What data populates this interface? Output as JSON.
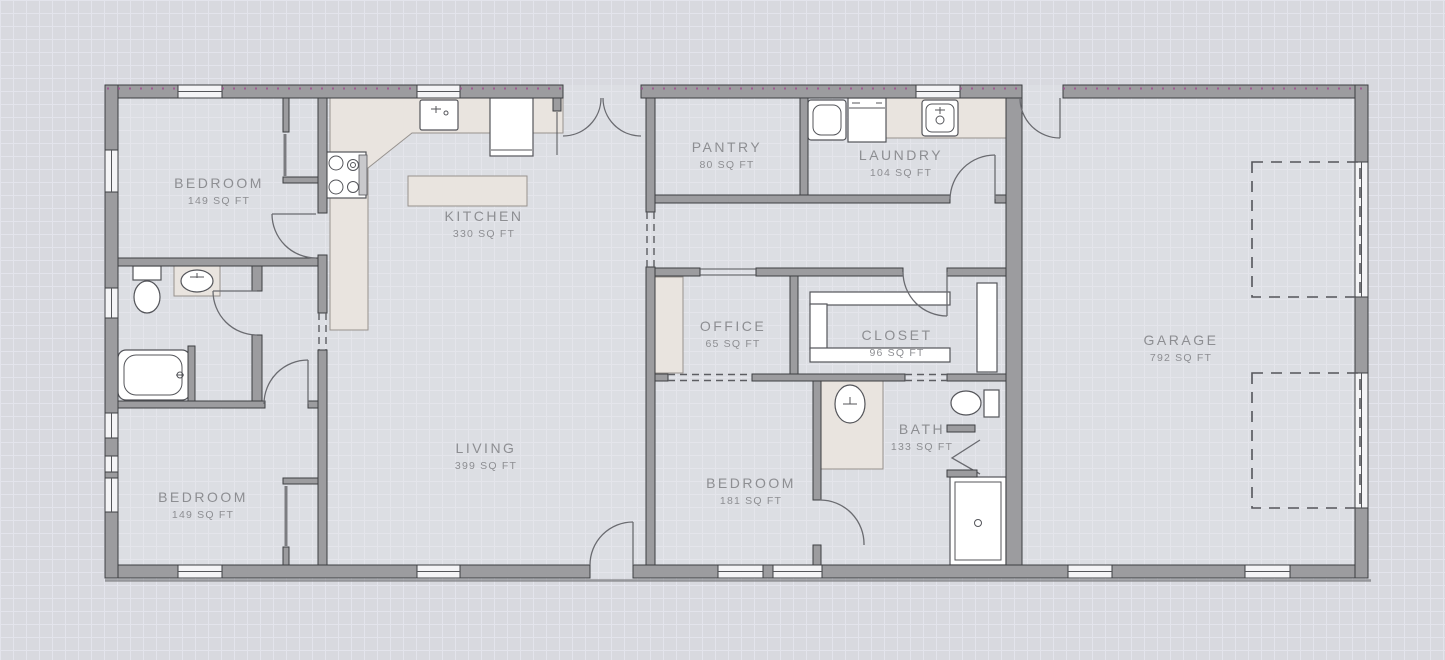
{
  "drawing": {
    "kind": "residential floor plan",
    "colors": {
      "background": "#d8d9df",
      "grid_line": "#e3e4ec",
      "wall_fill": "#9c9c9f",
      "wall_outline": "#3d3e42",
      "counter_fill": "#e9e4df",
      "fixture_outline": "#54555a",
      "label_text": "#8d8e92",
      "top_wall_hatch_dots": "#a14b90"
    }
  },
  "rooms": [
    {
      "id": "bedroom-top-left",
      "name": "BEDROOM",
      "area": "149 SQ FT",
      "label_x": 219,
      "label_y": 188
    },
    {
      "id": "kitchen",
      "name": "KITCHEN",
      "area": "330 SQ FT",
      "label_x": 484,
      "label_y": 221
    },
    {
      "id": "pantry",
      "name": "PANTRY",
      "area": "80 SQ FT",
      "label_x": 727,
      "label_y": 152
    },
    {
      "id": "laundry",
      "name": "LAUNDRY",
      "area": "104 SQ FT",
      "label_x": 901,
      "label_y": 160
    },
    {
      "id": "office",
      "name": "OFFICE",
      "area": "65 SQ FT",
      "label_x": 733,
      "label_y": 331
    },
    {
      "id": "closet",
      "name": "CLOSET",
      "area": "96 SQ FT",
      "label_x": 897,
      "label_y": 340
    },
    {
      "id": "garage",
      "name": "GARAGE",
      "area": "792 SQ FT",
      "label_x": 1181,
      "label_y": 345
    },
    {
      "id": "living",
      "name": "LIVING",
      "area": "399 SQ FT",
      "label_x": 486,
      "label_y": 453
    },
    {
      "id": "bedroom-middle",
      "name": "BEDROOM",
      "area": "181 SQ FT",
      "label_x": 751,
      "label_y": 488
    },
    {
      "id": "bath",
      "name": "BATH",
      "area": "133 SQ FT",
      "label_x": 922,
      "label_y": 434
    },
    {
      "id": "bedroom-bottom-left",
      "name": "BEDROOM",
      "area": "149 SQ FT",
      "label_x": 203,
      "label_y": 502
    }
  ],
  "fixtures": [
    "kitchen-sink",
    "refrigerator",
    "stove",
    "kitchen-island",
    "kitchen-counter",
    "washer",
    "dryer",
    "laundry-sink",
    "laundry-counter",
    "toilet-hall-bath",
    "vanity-sink-hall-bath",
    "bathtub",
    "toilet-main-bath",
    "vanity-sink-main-bath",
    "shower",
    "closet-shelves",
    "office-builtin",
    "garage-door-left",
    "garage-door-right"
  ]
}
